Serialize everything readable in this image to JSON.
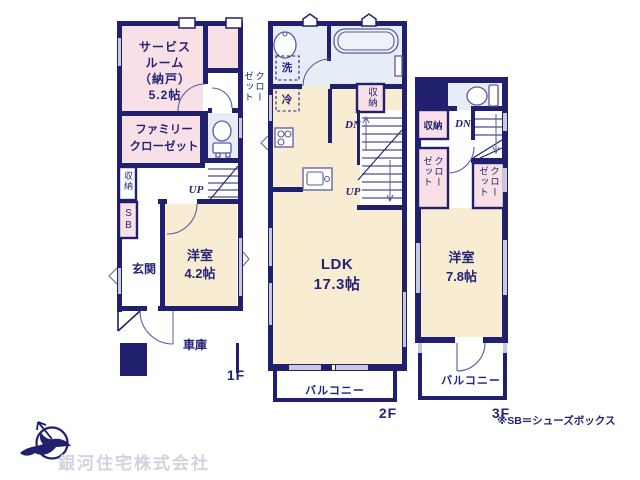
{
  "colors": {
    "wall": "#20206e",
    "ink": "#232377",
    "fixline": "#5b5b9e",
    "pink": "#f8e0e6",
    "cream": "#f8ecd2",
    "bath": "#e6edf6",
    "window": "#c6cadf",
    "logotext": "#d2d2e0"
  },
  "floor1": {
    "label": "1F",
    "service_room": "サービス\nルーム\n（納戸）\n5.2帖",
    "closet": "クローゼット",
    "family_closet": "ファミリー\nクローゼット",
    "storage": "収納",
    "shoe_box": "SB",
    "entrance": "玄関",
    "bedroom": "洋室\n4.2帖",
    "garage": "車庫",
    "stairs_up": "UP"
  },
  "floor2": {
    "label": "2F",
    "laundry": "洗",
    "fridge": "冷",
    "storage": "収納",
    "stairs_dn": "DN",
    "stairs_up": "UP",
    "ldk": "LDK\n17.3帖",
    "balcony": "バルコニー"
  },
  "floor3": {
    "label": "3F",
    "storage": "収納",
    "stairs_dn": "DN",
    "closet_left": "クローゼット",
    "closet_right": "クローゼット",
    "bedroom": "洋室\n7.8帖",
    "balcony": "バルコニー"
  },
  "footer": {
    "note": "※SB＝シューズボックス",
    "company": "銀河住宅株式会社"
  }
}
